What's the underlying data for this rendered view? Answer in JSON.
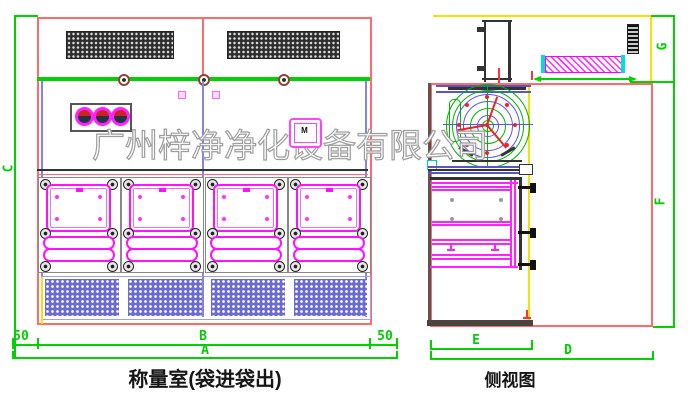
{
  "watermark": {
    "text": "广州梓净净化设备有限公司"
  },
  "front_view": {
    "caption": "称量室(袋进袋出)",
    "control_display_label": "M",
    "dims": {
      "height": "C",
      "inner_width": "B",
      "total_width": "A",
      "left_margin": "50",
      "right_margin": "50"
    }
  },
  "side_view": {
    "caption": "侧视图",
    "dims": {
      "top_height": "G",
      "body_height": "F",
      "body_depth": "E",
      "total_depth": "D"
    }
  },
  "colors": {
    "cad_red": "#ff6a6a",
    "cad_green": "#00d400",
    "cad_magenta": "#ff00ff",
    "cad_blue": "#8585e0",
    "cad_yellow": "#f2e400",
    "grille_dark": "#2e2e2e",
    "grille_blue": "#6b6bd6"
  }
}
